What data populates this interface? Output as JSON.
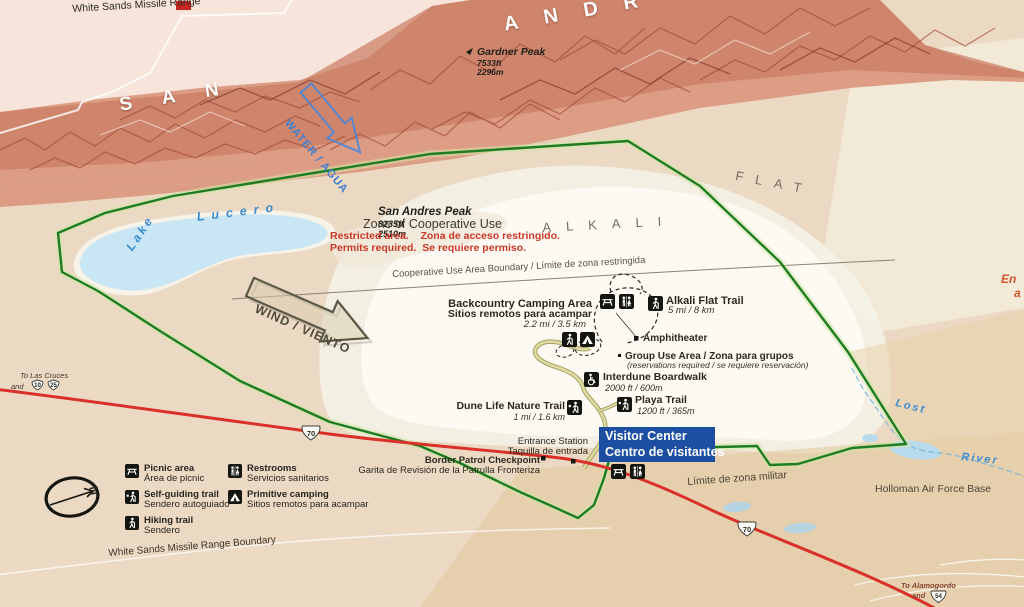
{
  "colors": {
    "park_boundary_green": "#1e7d22",
    "highway_red": "#d93129",
    "water_blue": "#3e8cd0",
    "visitor_center_blue": "#1c4fa1",
    "restricted_red": "#cb3726",
    "edge_text_orange": "#d2542e"
  },
  "icons": [
    "picnic-table",
    "restrooms",
    "hiking-trail",
    "self-guiding-trail",
    "primitive-camping-tent",
    "wheelchair-accessible",
    "north-arrow",
    "us-route-shield",
    "interstate-shield",
    "water-direction-arrow",
    "wind-direction-arrow"
  ],
  "top": {
    "missile_range": "White Sands Missile Range",
    "san_letters": "SAN",
    "andr_letters": "ANDR",
    "san_andres_peak": {
      "name": "San Andres Peak",
      "elev_ft": "8235ft",
      "elev_m": "2510m"
    },
    "gardner_peak": {
      "name": "Gardner Peak",
      "elev_ft": "7533ft",
      "elev_m": "2296m"
    },
    "water_arrow": "WATER / AGUA"
  },
  "zone": {
    "title": "Zone of Cooperative Use",
    "line1": "Restricted area.    Zona de acceso restringido.",
    "line2": "Permits required.  Se requiere permiso.",
    "boundary_label": "Cooperative Use Area Boundary / Límite de zona restringida"
  },
  "features": {
    "lake_word": "Lake",
    "lucero_word": "Lucero",
    "alkali": "ALKALI",
    "flat": "FLAT",
    "wind_arrow": "WIND / VIENTO",
    "lost": "Lost",
    "river": "River"
  },
  "trails": {
    "backcountry": {
      "l1": "Backcountry Camping Area",
      "l2": "Sitios remotos para acampar",
      "dist": "2.2 mi / 3.5 km"
    },
    "alkali_flat": {
      "name": "Alkali Flat Trail",
      "dist": "5 mi / 8 km"
    },
    "amphitheater": "Amphitheater",
    "group_use": {
      "l1": "Group Use Area / Zona para grupos",
      "l2": "(reservations required / se requiere reservación)"
    },
    "interdune": {
      "name": "Interdune Boardwalk",
      "dist": "2000 ft / 600m"
    },
    "playa": {
      "name": "Playa Trail",
      "dist": "1200 ft / 365m"
    },
    "dune_life": {
      "name": "Dune Life Nature Trail",
      "dist": "1 mi / 1.6 km"
    }
  },
  "facilities": {
    "visitor_center": {
      "l1": "Visitor Center",
      "l2": "Centro de visitantes"
    },
    "entrance_station": {
      "l1": "Entrance Station",
      "l2": "Taquilla de entrada"
    },
    "border_patrol": {
      "l1": "Border Patrol Checkpoint",
      "l2": "Garita de Revisión de la Patrulla Fronteriza"
    }
  },
  "periphery": {
    "to_las_cruces": {
      "l1": "To Las Cruces",
      "l2": "and"
    },
    "to_alamogordo": {
      "l1": "To Alamogordo",
      "l2": "and"
    },
    "routes": {
      "i10": "10",
      "i25": "25",
      "us70": "70",
      "us54": "54"
    },
    "zona_militar": "Límite de zona militar",
    "holloman": "Holloman Air Force Base",
    "wsmr_boundary": "White Sands Missile Range Boundary",
    "edge_fragment": {
      "l1": "En",
      "l2": "a"
    }
  },
  "legend": {
    "north": "N",
    "items": [
      {
        "icon": "picnic-table",
        "l1": "Picnic area",
        "l2": "Área de picnic"
      },
      {
        "icon": "self-guiding-trail",
        "l1": "Self-guiding trail",
        "l2": "Sendero autoguiado"
      },
      {
        "icon": "hiking-trail",
        "l1": "Hiking trail",
        "l2": "Sendero"
      },
      {
        "icon": "restrooms",
        "l1": "Restrooms",
        "l2": "Servicios sanitarios"
      },
      {
        "icon": "primitive-camping",
        "l1": "Primitive camping",
        "l2": "Sitios remotos para acampar"
      }
    ]
  }
}
